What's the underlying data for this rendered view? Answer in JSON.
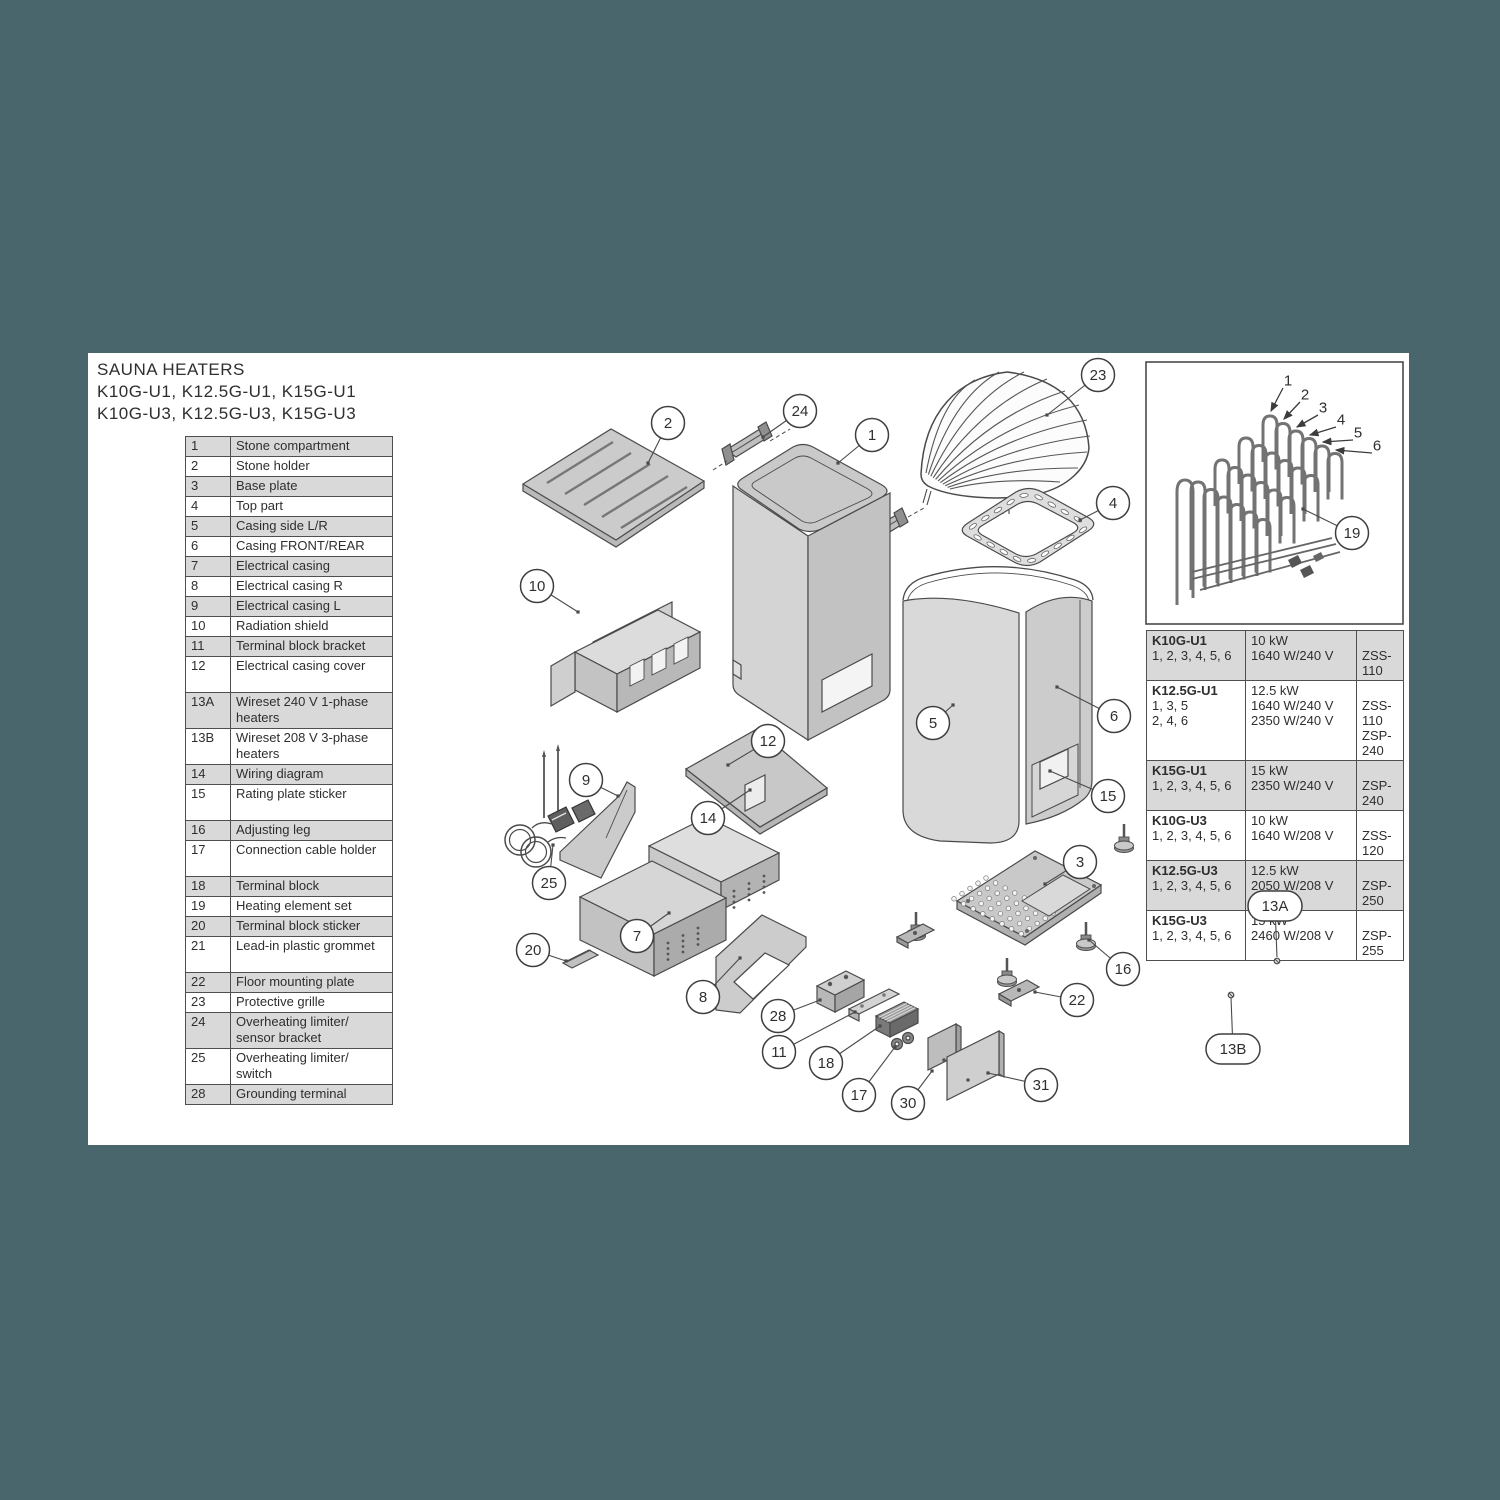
{
  "colors": {
    "background": "#4a666d",
    "paper": "#ffffff",
    "row_shade": "#d9d9d9",
    "line": "#4a4a4a"
  },
  "title": {
    "line1": "SAUNA HEATERS",
    "line2": "K10G-U1, K12.5G-U1, K15G-U1",
    "line3": "K10G-U3, K12.5G-U3, K15G-U3"
  },
  "parts_list": {
    "rows": [
      {
        "num": "1",
        "desc": "Stone compartment",
        "shaded": true,
        "tall": false
      },
      {
        "num": "2",
        "desc": "Stone holder",
        "shaded": false,
        "tall": false
      },
      {
        "num": "3",
        "desc": "Base plate",
        "shaded": true,
        "tall": false
      },
      {
        "num": "4",
        "desc": "Top part",
        "shaded": false,
        "tall": false
      },
      {
        "num": "5",
        "desc": "Casing side L/R",
        "shaded": true,
        "tall": false
      },
      {
        "num": "6",
        "desc": "Casing FRONT/REAR",
        "shaded": false,
        "tall": false
      },
      {
        "num": "7",
        "desc": "Electrical casing",
        "shaded": true,
        "tall": false
      },
      {
        "num": "8",
        "desc": "Electrical casing R",
        "shaded": false,
        "tall": false
      },
      {
        "num": "9",
        "desc": "Electrical casing L",
        "shaded": true,
        "tall": false
      },
      {
        "num": "10",
        "desc": "Radiation shield",
        "shaded": false,
        "tall": false
      },
      {
        "num": "11",
        "desc": "Terminal block bracket",
        "shaded": true,
        "tall": false
      },
      {
        "num": "12",
        "desc": "Electrical casing cover",
        "shaded": false,
        "tall": true
      },
      {
        "num": "13A",
        "desc": "Wireset 240 V 1-phase heaters",
        "shaded": true,
        "tall": true
      },
      {
        "num": "13B",
        "desc": "Wireset 208 V 3-phase heaters",
        "shaded": false,
        "tall": true
      },
      {
        "num": "14",
        "desc": "Wiring diagram",
        "shaded": true,
        "tall": false
      },
      {
        "num": "15",
        "desc": "Rating plate sticker",
        "shaded": false,
        "tall": true
      },
      {
        "num": "16",
        "desc": "Adjusting leg",
        "shaded": true,
        "tall": false
      },
      {
        "num": "17",
        "desc": "Connection cable holder",
        "shaded": false,
        "tall": true
      },
      {
        "num": "18",
        "desc": "Terminal block",
        "shaded": true,
        "tall": false
      },
      {
        "num": "19",
        "desc": "Heating element set",
        "shaded": false,
        "tall": false
      },
      {
        "num": "20",
        "desc": "Terminal block sticker",
        "shaded": true,
        "tall": false
      },
      {
        "num": "21",
        "desc": "Lead-in plastic grommet",
        "shaded": false,
        "tall": true
      },
      {
        "num": "22",
        "desc": "Floor mounting plate",
        "shaded": true,
        "tall": false
      },
      {
        "num": "23",
        "desc": "Protective grille",
        "shaded": false,
        "tall": false
      },
      {
        "num": "24",
        "desc": "Overheating limiter/ sensor bracket",
        "shaded": true,
        "tall": true
      },
      {
        "num": "25",
        "desc": "Overheating limiter/ switch",
        "shaded": false,
        "tall": true
      },
      {
        "num": "28",
        "desc": "Grounding terminal",
        "shaded": true,
        "tall": false
      }
    ]
  },
  "spec_table": {
    "rows": [
      {
        "model": [
          "K10G-U1",
          "1, 2, 3, 4, 5, 6"
        ],
        "power": [
          "10 kW",
          "1640 W/240 V"
        ],
        "code": [
          "",
          "ZSS-110"
        ],
        "shaded": true
      },
      {
        "model": [
          "K12.5G-U1",
          "1, 3, 5",
          "2, 4, 6"
        ],
        "power": [
          "12.5 kW",
          "1640 W/240 V",
          "2350 W/240 V"
        ],
        "code": [
          "",
          "ZSS-110",
          "ZSP-240"
        ],
        "shaded": false
      },
      {
        "model": [
          "K15G-U1",
          "1, 2, 3, 4, 5, 6"
        ],
        "power": [
          "15 kW",
          "2350 W/240 V"
        ],
        "code": [
          "",
          "ZSP-240"
        ],
        "shaded": true
      },
      {
        "model": [
          "K10G-U3",
          "1, 2, 3, 4, 5, 6"
        ],
        "power": [
          "10 kW",
          "1640 W/208 V"
        ],
        "code": [
          "",
          "ZSS-120"
        ],
        "shaded": false
      },
      {
        "model": [
          "K12.5G-U3",
          "1, 2, 3, 4, 5, 6"
        ],
        "power": [
          "12.5 kW",
          "2050 W/208 V"
        ],
        "code": [
          "",
          "ZSP-250"
        ],
        "shaded": true
      },
      {
        "model": [
          "K15G-U3",
          "1, 2, 3, 4, 5, 6"
        ],
        "power": [
          "15 kW",
          "2460 W/208 V"
        ],
        "code": [
          "",
          "ZSP-255"
        ],
        "shaded": false
      }
    ]
  },
  "inset": {
    "labels": [
      {
        "t": "1",
        "x": 1288,
        "y": 381,
        "ax": 1271,
        "ay": 411
      },
      {
        "t": "2",
        "x": 1305,
        "y": 395,
        "ax": 1284,
        "ay": 419
      },
      {
        "t": "3",
        "x": 1323,
        "y": 408,
        "ax": 1297,
        "ay": 427
      },
      {
        "t": "4",
        "x": 1341,
        "y": 420,
        "ax": 1310,
        "ay": 435
      },
      {
        "t": "5",
        "x": 1358,
        "y": 433,
        "ax": 1323,
        "ay": 442
      },
      {
        "t": "6",
        "x": 1377,
        "y": 446,
        "ax": 1336,
        "ay": 450
      }
    ]
  },
  "diagram": {
    "callouts": [
      {
        "t": "2",
        "x": 668,
        "y": 423,
        "tx": 648,
        "ty": 463
      },
      {
        "t": "24",
        "x": 800,
        "y": 411,
        "tx": 763,
        "ty": 437
      },
      {
        "t": "1",
        "x": 872,
        "y": 435,
        "tx": 838,
        "ty": 463
      },
      {
        "t": "23",
        "x": 1098,
        "y": 375,
        "tx": 1047,
        "ty": 415
      },
      {
        "t": "4",
        "x": 1113,
        "y": 503,
        "tx": 1080,
        "ty": 520
      },
      {
        "t": "10",
        "x": 537,
        "y": 586,
        "tx": 578,
        "ty": 612
      },
      {
        "t": "5",
        "x": 933,
        "y": 723,
        "tx": 953,
        "ty": 705
      },
      {
        "t": "6",
        "x": 1114,
        "y": 716,
        "tx": 1057,
        "ty": 687
      },
      {
        "t": "15",
        "x": 1108,
        "y": 796,
        "tx": 1050,
        "ty": 771
      },
      {
        "t": "12",
        "x": 768,
        "y": 741,
        "tx": 728,
        "ty": 765
      },
      {
        "t": "14",
        "x": 708,
        "y": 818,
        "tx": 750,
        "ty": 790
      },
      {
        "t": "9",
        "x": 586,
        "y": 780,
        "tx": 618,
        "ty": 796
      },
      {
        "t": "25",
        "x": 549,
        "y": 883,
        "tx": 553,
        "ty": 845
      },
      {
        "t": "7",
        "x": 637,
        "y": 936,
        "tx": 669,
        "ty": 913
      },
      {
        "t": "20",
        "x": 533,
        "y": 950,
        "tx": 566,
        "ty": 961
      },
      {
        "t": "8",
        "x": 703,
        "y": 997,
        "tx": 740,
        "ty": 958
      },
      {
        "t": "28",
        "x": 778,
        "y": 1016,
        "tx": 820,
        "ty": 1000
      },
      {
        "t": "11",
        "x": 779,
        "y": 1052,
        "tx": 855,
        "ty": 1012
      },
      {
        "t": "18",
        "x": 826,
        "y": 1063,
        "tx": 880,
        "ty": 1026
      },
      {
        "t": "17",
        "x": 859,
        "y": 1095,
        "tx": 895,
        "ty": 1047
      },
      {
        "t": "30",
        "x": 908,
        "y": 1103,
        "tx": 932,
        "ty": 1071
      },
      {
        "t": "31",
        "x": 1041,
        "y": 1085,
        "tx": 988,
        "ty": 1073
      },
      {
        "t": "22",
        "x": 1077,
        "y": 1000,
        "tx": 1035,
        "ty": 992
      },
      {
        "t": "3",
        "x": 1080,
        "y": 862,
        "tx": 1045,
        "ty": 884
      },
      {
        "t": "16",
        "x": 1123,
        "y": 969,
        "tx": 1089,
        "ty": 940
      },
      {
        "t": "19",
        "x": 1352,
        "y": 533,
        "tx": 1303,
        "ty": 509
      }
    ],
    "stadium_callouts": [
      {
        "t": "13A",
        "x": 1275,
        "y": 906,
        "tx": 1277,
        "ty": 957
      },
      {
        "t": "13B",
        "x": 1233,
        "y": 1049,
        "tx": 1231,
        "ty": 998
      }
    ]
  }
}
